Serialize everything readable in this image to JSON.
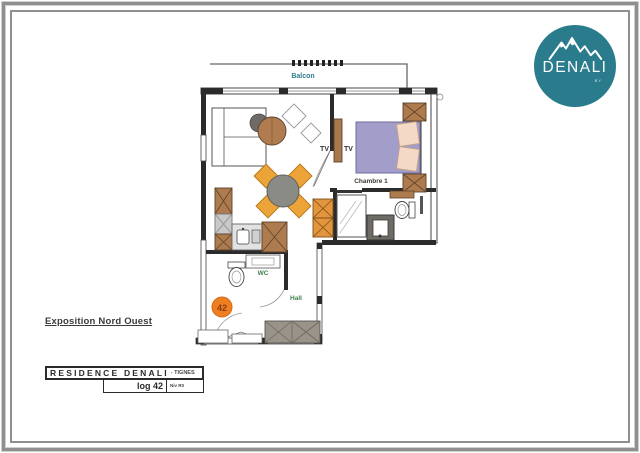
{
  "logo": {
    "brand": "DENALI",
    "tagline": "BY",
    "bg_color": "#2a7c8d"
  },
  "exposition_note": "Exposition Nord Ouest",
  "title_block": {
    "residence": "RESIDENCE DENALI",
    "location_suffix": "- TIGNES",
    "unit": "log 42",
    "level": "Niv R0"
  },
  "floor_plan": {
    "rooms": {
      "balcony": "Balcon",
      "bedroom": "Chambre 1",
      "wc": "WC",
      "hall": "Hall"
    },
    "labels": {
      "tv_living": "TV",
      "tv_bedroom": "TV"
    },
    "unit_badge": "42",
    "colors": {
      "wall": "#2b2b2b",
      "wood": "#ad7b4e",
      "chair_orange": "#eca337",
      "cabinet_orange": "#e2953c",
      "badge_orange": "#ee7e20",
      "bed_purple": "#a29dc9",
      "pillow_pink": "#f4dac6",
      "vanity_gray": "#6f6b66",
      "closet_gray": "#9a9389",
      "label_green": "#3e7d4a",
      "label_teal": "#2e7f8f"
    }
  }
}
